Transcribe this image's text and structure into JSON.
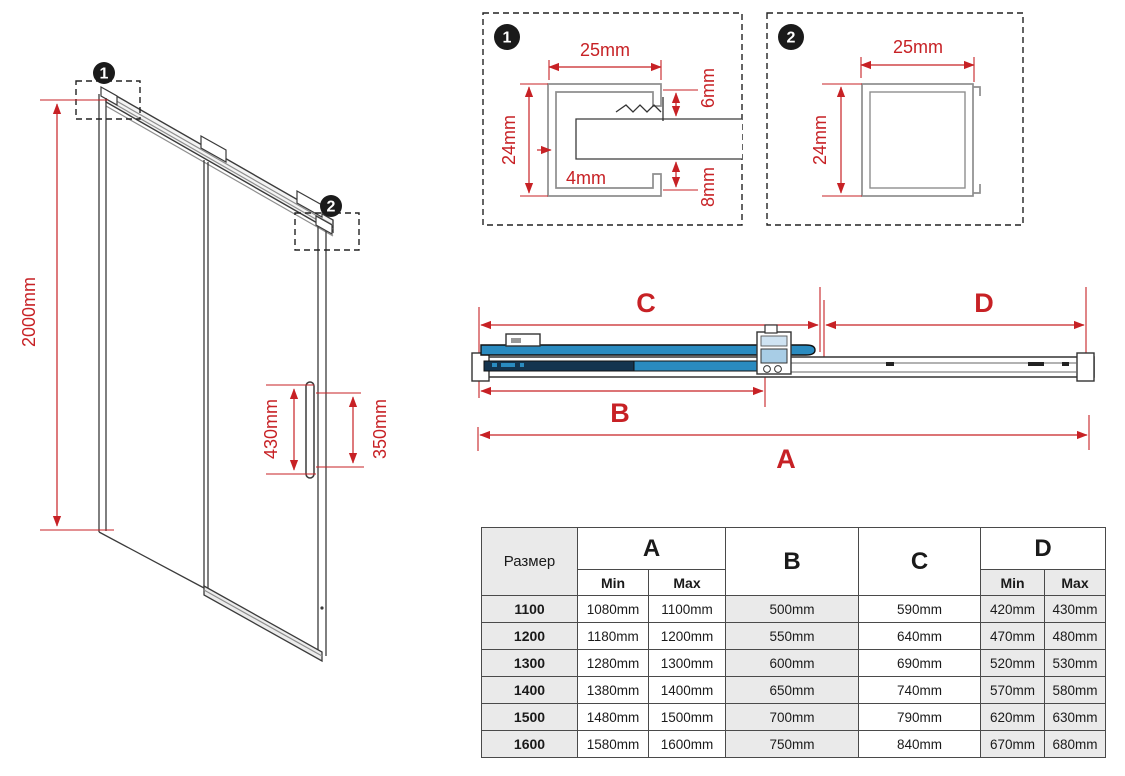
{
  "colors": {
    "accent_red": "#c72125",
    "glass_blue": "#2a8bc0",
    "glass_overlap_dark": "#14344f",
    "table_gray": "#eaeaea",
    "line_dark": "#3b3b3b",
    "profile_gray": "#8e8e8e"
  },
  "markers": {
    "m1": "1",
    "m2": "2"
  },
  "isometric": {
    "height_label": "2000mm",
    "handle_height_label": "430mm",
    "handle_span_label": "350mm"
  },
  "detail1": {
    "width_label": "25mm",
    "height_label": "24mm",
    "gap_top_label": "6mm",
    "wall_label": "4mm",
    "gap_bottom_label": "8mm"
  },
  "detail2": {
    "width_label": "25mm",
    "height_label": "24mm"
  },
  "top_view": {
    "dim_a": "A",
    "dim_b": "B",
    "dim_c": "C",
    "dim_d": "D"
  },
  "table": {
    "size_header": "Размер",
    "col_a": "A",
    "col_b": "B",
    "col_c": "C",
    "col_d": "D",
    "min_label": "Min",
    "max_label": "Max",
    "rows": [
      [
        "1100",
        "1080mm",
        "1100mm",
        "500mm",
        "590mm",
        "420mm",
        "430mm"
      ],
      [
        "1200",
        "1180mm",
        "1200mm",
        "550mm",
        "640mm",
        "470mm",
        "480mm"
      ],
      [
        "1300",
        "1280mm",
        "1300mm",
        "600mm",
        "690mm",
        "520mm",
        "530mm"
      ],
      [
        "1400",
        "1380mm",
        "1400mm",
        "650mm",
        "740mm",
        "570mm",
        "580mm"
      ],
      [
        "1500",
        "1480mm",
        "1500mm",
        "700mm",
        "790mm",
        "620mm",
        "630mm"
      ],
      [
        "1600",
        "1580mm",
        "1600mm",
        "750mm",
        "840mm",
        "670mm",
        "680mm"
      ]
    ]
  }
}
